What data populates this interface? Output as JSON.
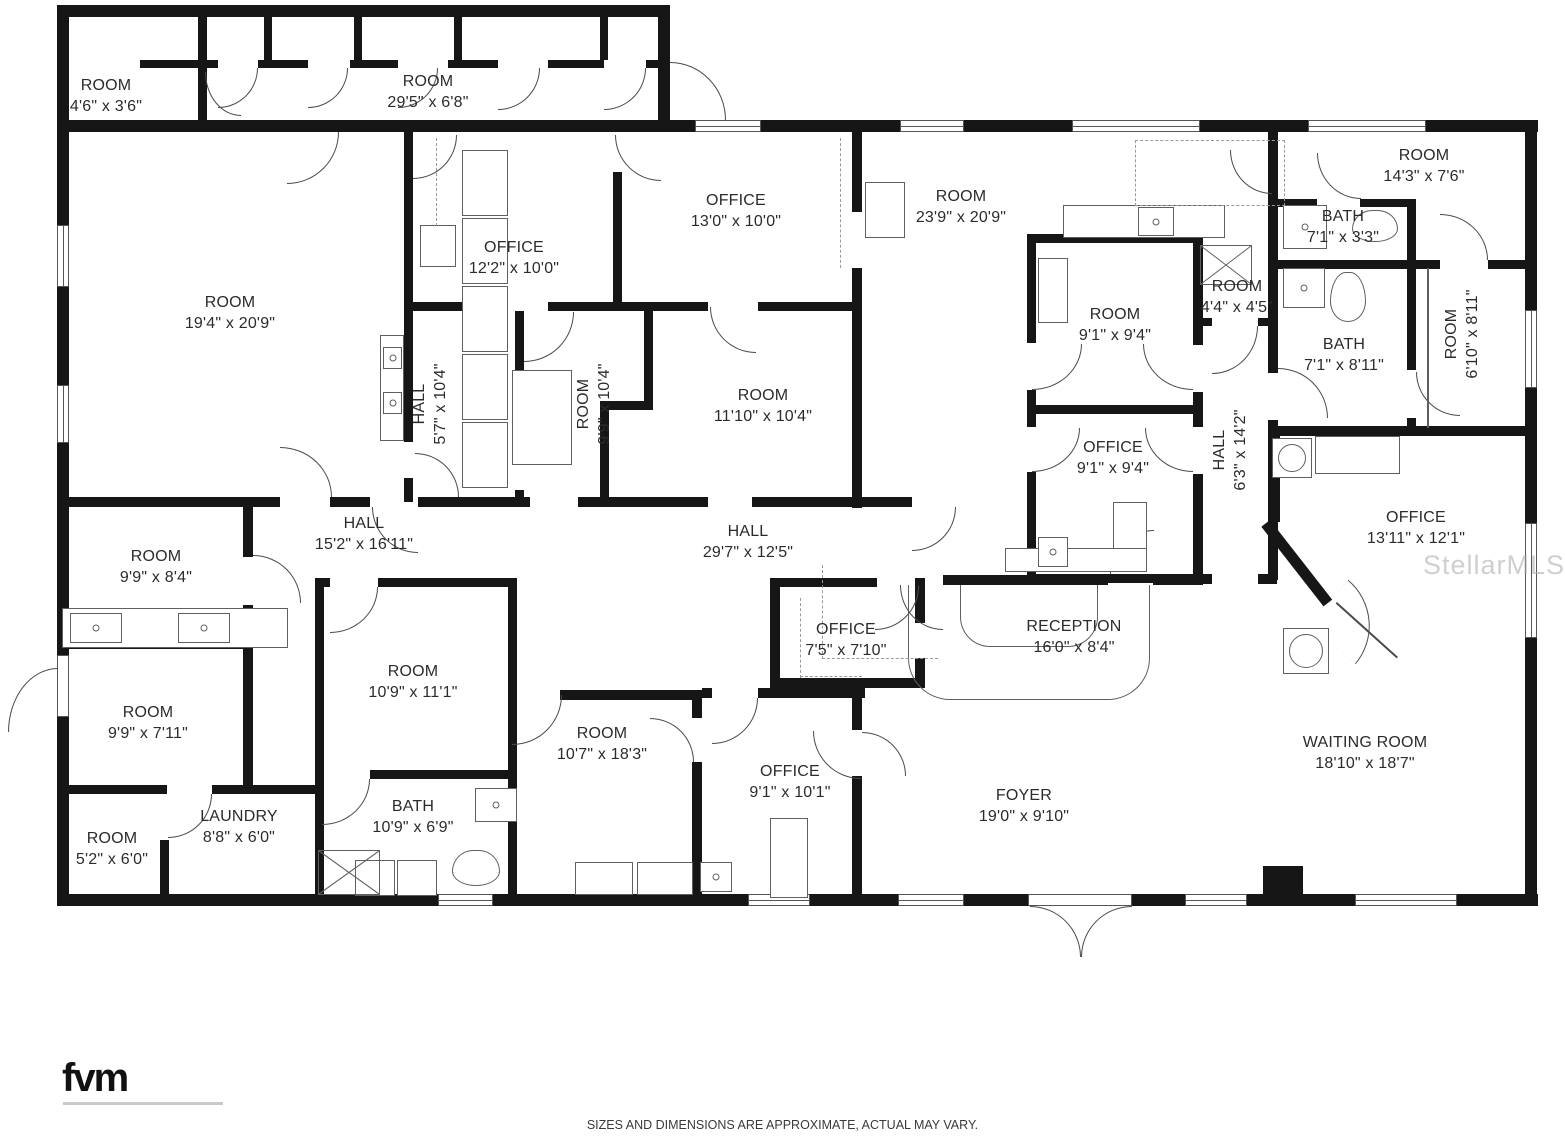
{
  "watermark": "StellarMLS",
  "footer": {
    "logo_text": "fvm",
    "disclaimer": "SIZES AND DIMENSIONS ARE APPROXIMATE, ACTUAL MAY VARY."
  },
  "plan": {
    "rooms": [
      {
        "name": "ROOM",
        "dims": "4'6\" x 3'6\"",
        "x": 106,
        "y": 96,
        "rot": 0
      },
      {
        "name": "ROOM",
        "dims": "29'5\" x 6'8\"",
        "x": 428,
        "y": 92,
        "rot": 0
      },
      {
        "name": "ROOM",
        "dims": "19'4\" x 20'9\"",
        "x": 230,
        "y": 313,
        "rot": 0
      },
      {
        "name": "OFFICE",
        "dims": "12'2\" x 10'0\"",
        "x": 514,
        "y": 258,
        "rot": 0
      },
      {
        "name": "OFFICE",
        "dims": "13'0\" x 10'0\"",
        "x": 736,
        "y": 211,
        "rot": 0
      },
      {
        "name": "ROOM",
        "dims": "23'9\" x 20'9\"",
        "x": 961,
        "y": 207,
        "rot": 0
      },
      {
        "name": "ROOM",
        "dims": "14'3\" x 7'6\"",
        "x": 1424,
        "y": 166,
        "rot": 0
      },
      {
        "name": "BATH",
        "dims": "7'1\" x 3'3\"",
        "x": 1343,
        "y": 227,
        "rot": 0
      },
      {
        "name": "ROOM",
        "dims": "4'4\" x 4'5\"",
        "x": 1237,
        "y": 297,
        "rot": 0
      },
      {
        "name": "BATH",
        "dims": "7'1\" x 8'11\"",
        "x": 1344,
        "y": 355,
        "rot": 0
      },
      {
        "name": "ROOM",
        "dims": "6'10\" x 8'11\"",
        "x": 1462,
        "y": 334,
        "rot": -90
      },
      {
        "name": "HALL",
        "dims": "5'7\" x 10'4\"",
        "x": 430,
        "y": 404,
        "rot": -90
      },
      {
        "name": "ROOM",
        "dims": "9'9\" x 10'4\"",
        "x": 594,
        "y": 404,
        "rot": -90
      },
      {
        "name": "ROOM",
        "dims": "11'10\" x 10'4\"",
        "x": 763,
        "y": 406,
        "rot": 0
      },
      {
        "name": "ROOM",
        "dims": "9'1\" x 9'4\"",
        "x": 1115,
        "y": 325,
        "rot": 0
      },
      {
        "name": "OFFICE",
        "dims": "9'1\" x 9'4\"",
        "x": 1113,
        "y": 458,
        "rot": 0
      },
      {
        "name": "HALL",
        "dims": "6'3\" x 14'2\"",
        "x": 1230,
        "y": 450,
        "rot": -90
      },
      {
        "name": "OFFICE",
        "dims": "13'11\" x 12'1\"",
        "x": 1416,
        "y": 528,
        "rot": 0
      },
      {
        "name": "HALL",
        "dims": "15'2\" x 16'11\"",
        "x": 364,
        "y": 534,
        "rot": 0
      },
      {
        "name": "HALL",
        "dims": "29'7\" x 12'5\"",
        "x": 748,
        "y": 542,
        "rot": 0
      },
      {
        "name": "ROOM",
        "dims": "9'9\" x 8'4\"",
        "x": 156,
        "y": 567,
        "rot": 0
      },
      {
        "name": "ROOM",
        "dims": "9'9\" x 7'11\"",
        "x": 148,
        "y": 723,
        "rot": 0
      },
      {
        "name": "ROOM",
        "dims": "10'9\" x 11'1\"",
        "x": 413,
        "y": 682,
        "rot": 0
      },
      {
        "name": "ROOM",
        "dims": "10'7\" x 18'3\"",
        "x": 602,
        "y": 744,
        "rot": 0
      },
      {
        "name": "OFFICE",
        "dims": "7'5\" x 7'10\"",
        "x": 846,
        "y": 640,
        "rot": 0
      },
      {
        "name": "RECEPTION",
        "dims": "16'0\" x 8'4\"",
        "x": 1074,
        "y": 637,
        "rot": 0
      },
      {
        "name": "OFFICE",
        "dims": "9'1\" x 10'1\"",
        "x": 790,
        "y": 782,
        "rot": 0
      },
      {
        "name": "FOYER",
        "dims": "19'0\" x 9'10\"",
        "x": 1024,
        "y": 806,
        "rot": 0
      },
      {
        "name": "WAITING ROOM",
        "dims": "18'10\" x 18'7\"",
        "x": 1365,
        "y": 753,
        "rot": 0
      },
      {
        "name": "ROOM",
        "dims": "5'2\" x 6'0\"",
        "x": 112,
        "y": 849,
        "rot": 0
      },
      {
        "name": "LAUNDRY",
        "dims": "8'8\" x 6'0\"",
        "x": 239,
        "y": 827,
        "rot": 0
      },
      {
        "name": "BATH",
        "dims": "10'9\" x 6'9\"",
        "x": 413,
        "y": 817,
        "rot": 0
      }
    ]
  }
}
